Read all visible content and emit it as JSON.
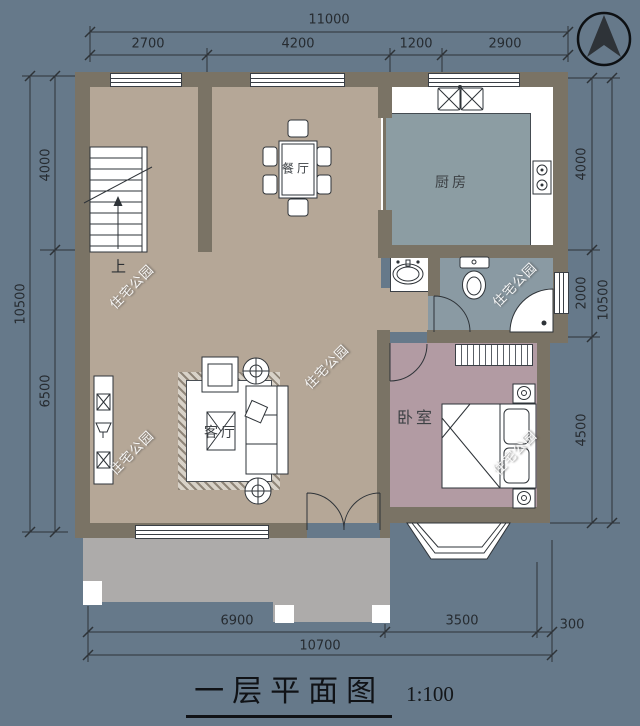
{
  "title": {
    "text": "一层平面图",
    "scale": "1:100"
  },
  "rooms": {
    "dining": "餐厅",
    "kitchen": "厨房",
    "living": "客厅",
    "bedroom": "卧室",
    "stairs_up": "上"
  },
  "watermark": {
    "text": "住宅公园"
  },
  "dims": {
    "top": {
      "total": "11000",
      "segments": [
        "2700",
        "4200",
        "1200",
        "2900"
      ]
    },
    "left": {
      "total": "10500",
      "segments": [
        "4000",
        "6500"
      ]
    },
    "right": {
      "total": "10500",
      "segments": [
        "4000",
        "2000",
        "4500"
      ]
    },
    "bottom": {
      "total": "10700",
      "segments": [
        "6900",
        "3500",
        "300"
      ]
    }
  },
  "colors": {
    "bg": "#66798a",
    "wall": "#7a7365",
    "floorMain": "#b5a797",
    "floorKitchen": "#8c9da3",
    "floorBath": "#8a9aa3",
    "floorBed": "#b29ba3",
    "porch": "#adabaa",
    "line": "#2e3338",
    "ink": "#23282d"
  }
}
